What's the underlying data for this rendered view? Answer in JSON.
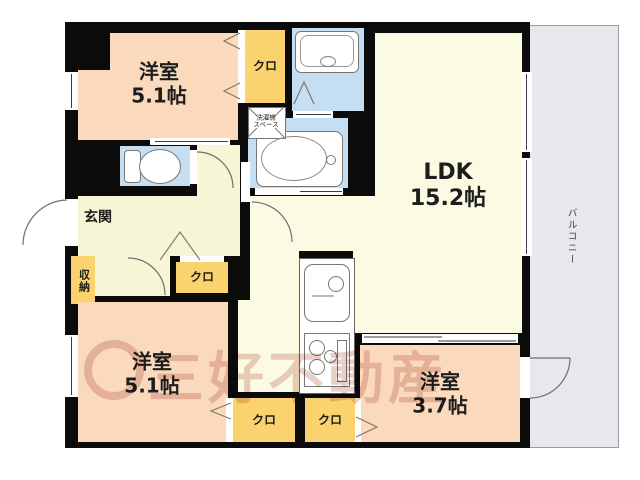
{
  "plan_title": "floor-plan",
  "rooms": {
    "bedroom1": {
      "name": "洋室",
      "size": "5.1帖"
    },
    "bedroom2": {
      "name": "洋室",
      "size": "5.1帖"
    },
    "bedroom3": {
      "name": "洋室",
      "size": "3.7帖"
    },
    "ldk": {
      "name": "LDK",
      "size": "15.2帖"
    },
    "entrance": {
      "label": "玄関"
    },
    "balcony": {
      "label": "バルコニー"
    },
    "storage": {
      "label": "収納"
    },
    "closet_top": {
      "label": "クロ"
    },
    "closet_mid": {
      "label": "クロ"
    },
    "closet_bottom_left": {
      "label": "クロ"
    },
    "closet_bottom_right": {
      "label": "クロ"
    },
    "washer_space": {
      "line1": "洗濯機",
      "line2": "スペース"
    }
  },
  "watermark": {
    "text": "三好不動産"
  },
  "colors": {
    "wall": "#0b0b0b",
    "room_peach": "#fad9bd",
    "closet_yellow": "#fbd36e",
    "wet_blue": "#c5def2",
    "hall_yellow": "#f6f5d6",
    "ldk_yellow": "#fbfae3",
    "balcony_gray": "#e9e7eb",
    "fixture_white": "#ffffff",
    "watermark_pink": "#e9cfca",
    "text_dark": "#1d1d1d"
  }
}
